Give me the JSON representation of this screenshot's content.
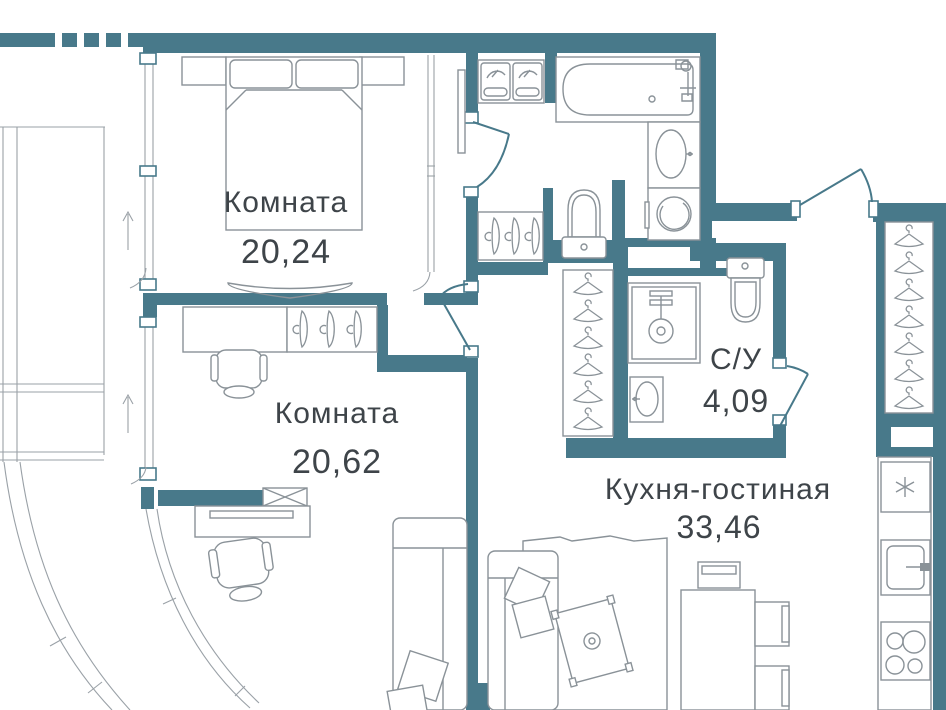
{
  "plan": {
    "title": "Apartment floor plan",
    "rooms": {
      "bedroom": {
        "name": "Комната",
        "area": "20,24"
      },
      "bedroom2": {
        "name": "Комната",
        "area": "20,62"
      },
      "bathroom_small": {
        "name": "С/У",
        "area": "4,09"
      },
      "kitchen_living": {
        "name": "Кухня-гостиная",
        "area": "33,46"
      }
    },
    "colors": {
      "wall": "#48798a",
      "furniture_line": "#8a9298",
      "glazing_line": "#9aa1a7",
      "text": "#3e4449",
      "background": "#ffffff"
    },
    "fixtures": [
      "bed",
      "nightstand",
      "tv-console",
      "mirror",
      "desk",
      "office-chair",
      "hanger-rack",
      "ventilation-shaft",
      "sofa",
      "cushions",
      "carpet",
      "coffee-table",
      "dining-table",
      "bench",
      "chair",
      "double-vanity",
      "bathtub",
      "sink",
      "washing-machine",
      "toilet",
      "shower",
      "wardrobe-hangers",
      "fridge",
      "kitchen-sink",
      "stove",
      "balcony-glazing",
      "entrance-door"
    ]
  }
}
